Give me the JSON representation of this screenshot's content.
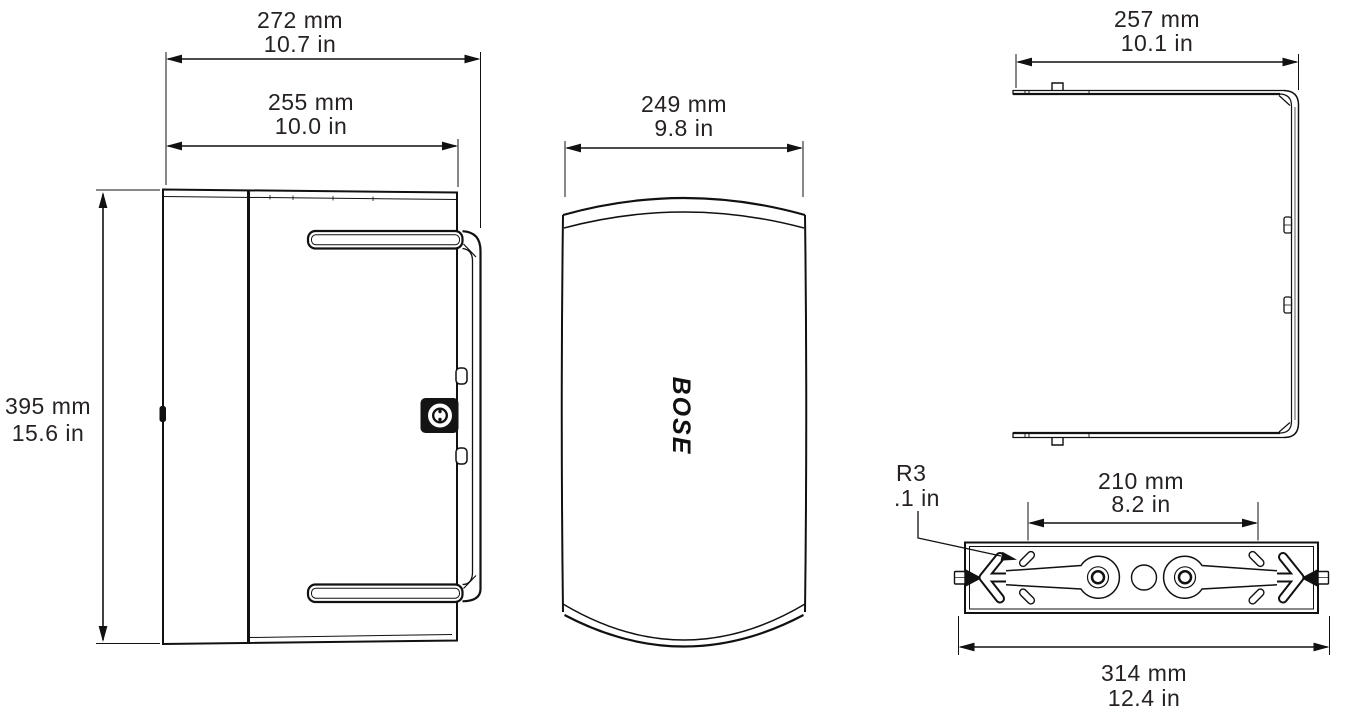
{
  "product": {
    "logo_text": "BOSE"
  },
  "dims": {
    "overall_width": {
      "metric": "272 mm",
      "imperial": "10.7 in"
    },
    "body_width": {
      "metric": "255 mm",
      "imperial": "10.0 in"
    },
    "height": {
      "metric": "395 mm",
      "imperial": "15.6 in"
    },
    "front_width": {
      "metric": "249 mm",
      "imperial": "9.8 in"
    },
    "bracket_width": {
      "metric": "257 mm",
      "imperial": "10.1 in"
    },
    "mount_spacing": {
      "metric": "210 mm",
      "imperial": "8.2 in"
    },
    "bracket_length": {
      "metric": "314 mm",
      "imperial": "12.4 in"
    },
    "slot_radius": {
      "metric": "R3",
      "imperial": ".1 in"
    }
  },
  "colors": {
    "line": "#111111",
    "text": "#262222",
    "background": "#ffffff"
  }
}
